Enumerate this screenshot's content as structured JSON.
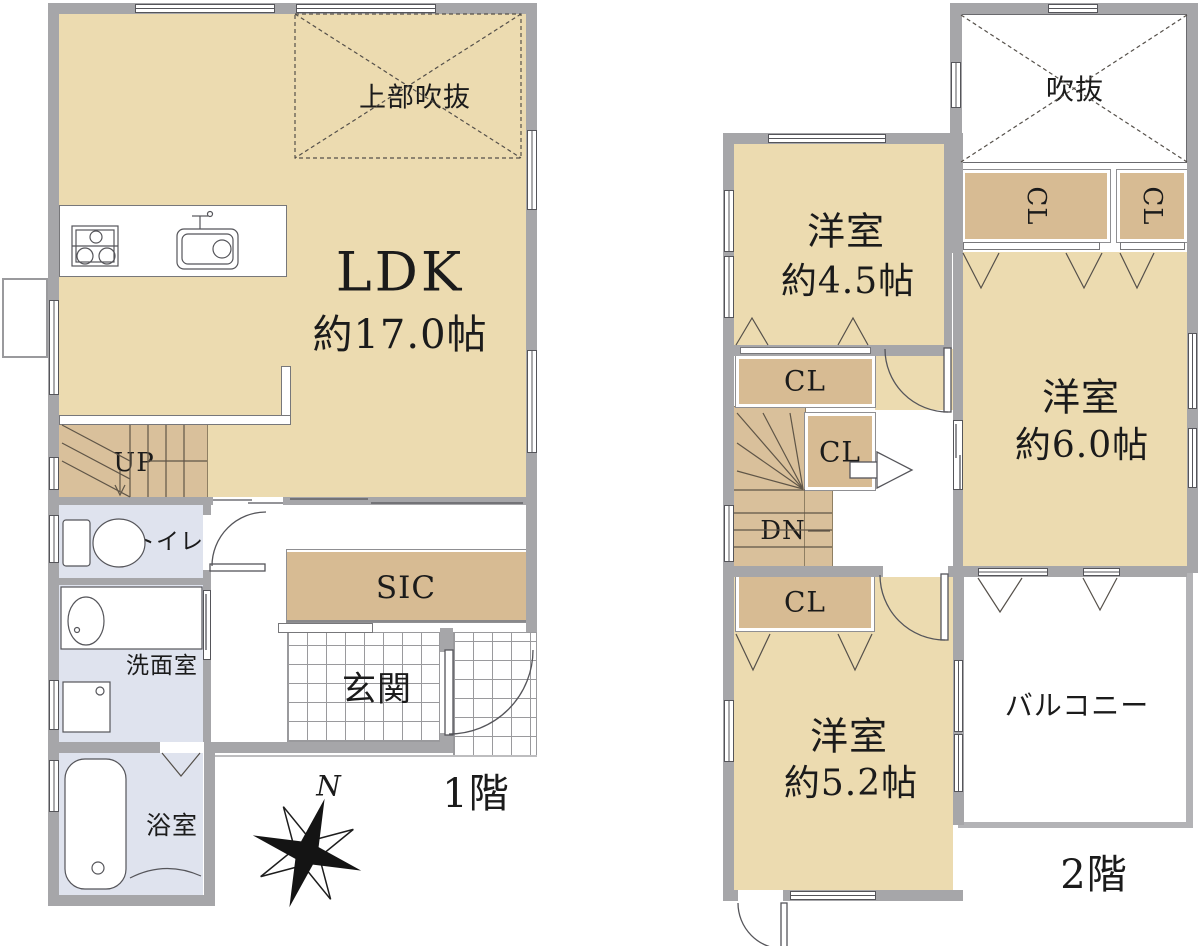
{
  "colors": {
    "floor_beige": "#ecdbb0",
    "closet_tan": "#d7bb93",
    "stairs_tan": "#d9c09b",
    "wet_blue": "#dfe3ee",
    "wall_gray": "#a6a6a9"
  },
  "floor1": {
    "floor_label": "1階",
    "ldk_name": "LDK",
    "ldk_size": "約17.0帖",
    "upper_void": "上部吹抜",
    "stairs_up": "UP",
    "toilet": "トイレ",
    "washroom": "洗面室",
    "bathroom": "浴室",
    "shoe_closet": "SIC",
    "entrance": "玄関",
    "compass_north": "N"
  },
  "floor2": {
    "floor_label": "2階",
    "void": "吹抜",
    "closet": "CL",
    "room_a_name": "洋室",
    "room_a_size": "約4.5帖",
    "room_b_name": "洋室",
    "room_b_size": "約6.0帖",
    "room_c_name": "洋室",
    "room_c_size": "約5.2帖",
    "stairs_down": "DN",
    "balcony": "バルコニー"
  }
}
